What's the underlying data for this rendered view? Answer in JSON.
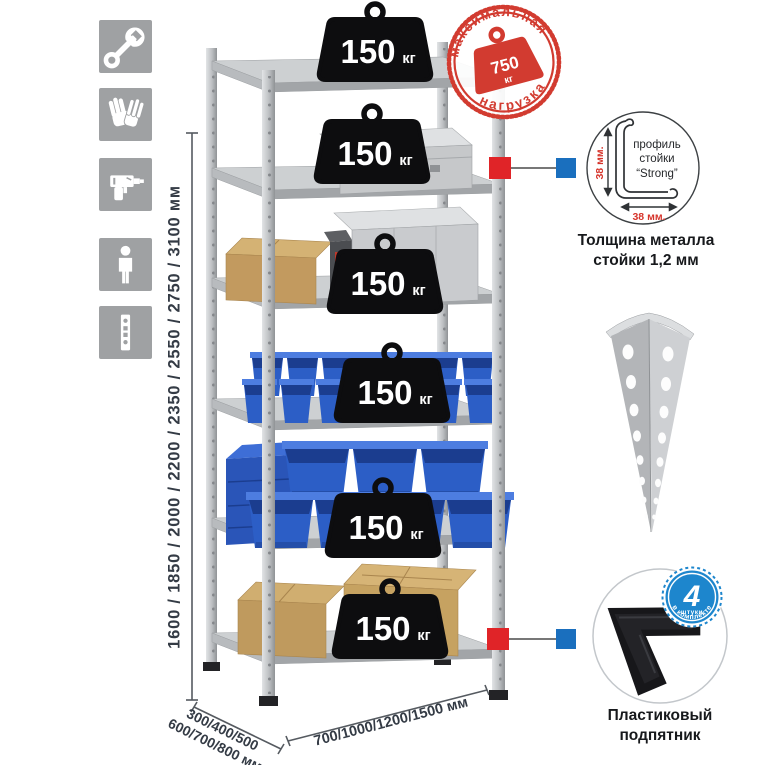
{
  "sidebar": {
    "icons": [
      {
        "name": "wrench"
      },
      {
        "name": "gloves"
      },
      {
        "name": "drill"
      },
      {
        "name": "person"
      },
      {
        "name": "perforated-post"
      }
    ]
  },
  "dimensions": {
    "height": "1600 / 1850 / 2000 / 2200 / 2350 / 2550 / 2750 / 3100 мм",
    "depth_line1": "300/400/500",
    "depth_line2": "600/700/800 мм",
    "width": "700/1000/1200/1500 мм"
  },
  "weights": [
    {
      "value": "150",
      "unit": "кг"
    },
    {
      "value": "150",
      "unit": "кг"
    },
    {
      "value": "150",
      "unit": "кг"
    },
    {
      "value": "150",
      "unit": "кг"
    },
    {
      "value": "150",
      "unit": "кг"
    },
    {
      "value": "150",
      "unit": "кг"
    }
  ],
  "stamp": {
    "arc_top": "максимальная",
    "arc_bottom": "нагрузка",
    "value": "750",
    "unit": "кг"
  },
  "profile_detail": {
    "line1": "профиль",
    "line2": "стойки",
    "line3": "“Strong”",
    "dim_vertical": "38 мм.",
    "dim_horizontal": "38 мм.",
    "caption_line1": "Толщина металла",
    "caption_line2": "стойки 1,2 мм"
  },
  "foot_detail": {
    "badge_value": "4",
    "badge_unit": "штуки",
    "badge_arc": "в комплекте",
    "caption_line1": "Пластиковый",
    "caption_line2": "подпятник"
  },
  "colors": {
    "accent_red": "#d23b30",
    "marker_red": "#e02428",
    "marker_blue": "#1a6fbe",
    "badge_blue": "#1d86cd",
    "bin_blue": "#2c5ec6"
  }
}
